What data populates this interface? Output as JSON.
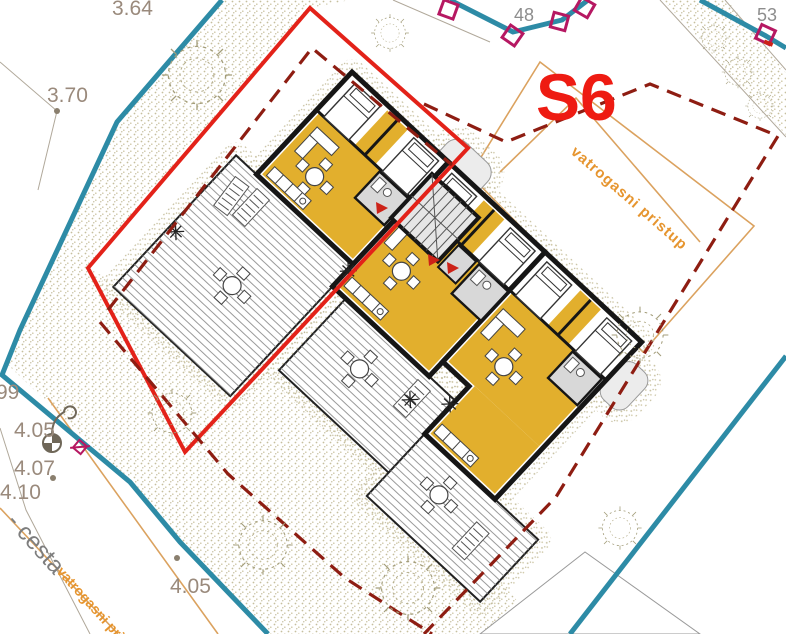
{
  "drawing": {
    "building_label": "S6",
    "parcel_points": {
      "p48": "48",
      "p53": "53"
    },
    "elevations": {
      "e364": "3.64",
      "e370": "3.70",
      "e399": "99",
      "e405_left": "4.05",
      "e407": "4.07",
      "e410": "4.10",
      "e405_bottom": "4.05"
    },
    "annotations": {
      "fire_access": "vatrogasni pristup",
      "fire_access_partial": "vatrogasni pri",
      "road": "- cesta"
    },
    "colors": {
      "parcel_boundary_teal": "#2d8ba6",
      "building_envelope_red": "#e32219",
      "setback_dashed_dark_red": "#8e1d12",
      "fire_access_orange": "#dba25f",
      "fire_access_text_orange": "#e6952f",
      "building_yellow": "#e2af2d",
      "survey_marker_magenta": "#b61862",
      "elevation_label_gray": "#9a8a7c",
      "building_id_red": "#ee1b12"
    }
  }
}
